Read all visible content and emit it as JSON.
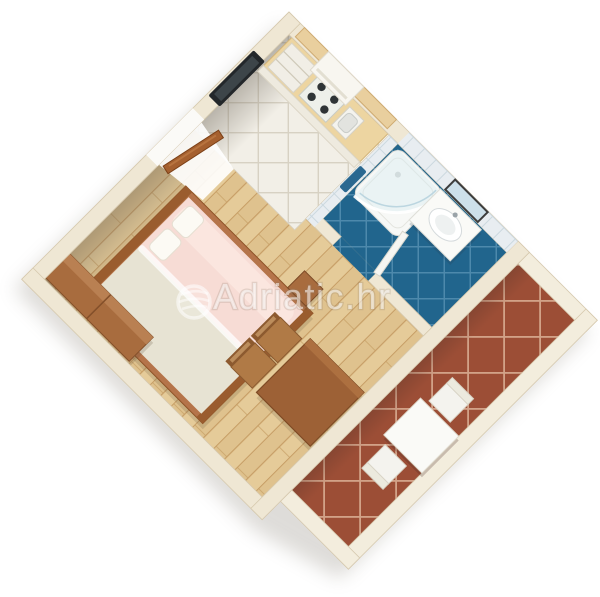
{
  "watermark": {
    "text": "Adriatic.hr",
    "icon": "globe-swoosh-icon"
  },
  "scene": {
    "type": "3d-floorplan-render",
    "subject": "studio-apartment-isometric-floor-plan",
    "rooms": [
      {
        "name": "main-room",
        "floor": "light-wood-planks",
        "items": [
          "double-bed-pink-bedding",
          "wardrobe-sideboard",
          "dining-table",
          "two-wooden-chairs",
          "bedside-stool",
          "wall-tv",
          "entrance-door-open"
        ]
      },
      {
        "name": "kitchenette",
        "floor": "white-diagonal-tiles",
        "items": [
          "counter-with-drawers",
          "stove-four-burners",
          "sink",
          "range-hood",
          "wall-shelf"
        ]
      },
      {
        "name": "bathroom",
        "floor": "blue-diagonal-tiles",
        "items": [
          "corner-shower-curved-glass",
          "washbasin-vanity",
          "wall-mirror",
          "towel",
          "bathroom-door-open"
        ]
      },
      {
        "name": "terrace",
        "floor": "terracotta-diagonal-tiles",
        "items": [
          "white-table",
          "two-white-chairs",
          "low-parapet-walls"
        ]
      }
    ]
  },
  "palette": {
    "wall": "#efe7d4",
    "wall-low": "#f3eddd",
    "wall-edge": "#d8cbb0",
    "wood-a": "#e5cb99",
    "wood-b": "#dfc28e",
    "wood-line": "#c79e66",
    "tile-white": "#f2efe7",
    "tile-white-line": "#d7d1c3",
    "bath-floor": "#21658d",
    "bath-floor-line": "#4d89ac",
    "bath-wall": "#e8edf1",
    "bath-wall-line": "#cbd8df",
    "terra": "#9c4e36",
    "terra-line": "#d2a288",
    "bed-pink": "#f7dcd5",
    "bed-pink-hi": "#fbe7e1",
    "bed-pale": "#e7e3d3",
    "frame-wood": "#b5744a",
    "dark-wood": "#9a5c2e",
    "cabinet-wood": "#a86c3e",
    "table-wood": "#9d6136",
    "chair-wood": "#b07a46",
    "counter-top": "#edd5a1",
    "white-furniture": "#fafaf7",
    "tv-dark": "#23272a",
    "shadow": "#8a8378",
    "watermark": "rgba(255,255,255,0.55)"
  }
}
